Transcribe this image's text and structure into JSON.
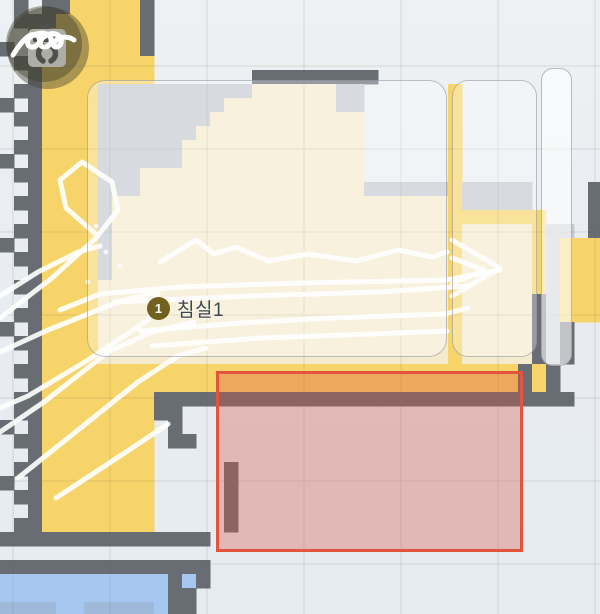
{
  "map": {
    "cell_size": 14,
    "room_label": {
      "badge": "1",
      "name": "침실1"
    },
    "palette": {
      "W": "#686d73",
      "Y": "#f6d469",
      "C": "#f4ebcd",
      "G": "#c5c9d0",
      "B": "#a6c8f0",
      "b": "#9fb9da"
    },
    "rows": [
      ".W.WWYYYYYW................................",
      ".WWWYYYYYYW................................",
      "..WYYYYYYYW................................",
      "W.WYYYYYYYW................................",
      ".WWYYYYYYYY................................",
      "..WYYYYYYYY.......WWWWWWWWW................",
      ".WWYYYYGGGGGGGGGGGCCCCCCGG......Y..........",
      "W.WYYYYGGGGGGGGGCCCCCCCCGG......Y..........",
      ".WWYYYYGGGGGGGGCCCCCCCCCCC......Y..........",
      "..WYYYYGGGGGGGCCCCCCCCCCCC......Y..........",
      ".WWYYYYGGGGGGCCCCCCCCCCCCC......Y..........",
      "W.WYYYYGGGGGGCCCCCCCCCCCCC......Y..........",
      ".WWYYYYGGGCCCCCCCCCCCCCCCC......Y..........",
      "..WYYYYGGGCCCCCCCCCCCCCCCCGGGGGGYGGGGG....W",
      ".WWYYYYGCCCCCCCCCCCCCCCCCCCCCCCCYGGGGG....W",
      "..WYYYYGCCCCCCCCCCCCCCCCCCCCCCCCYYYYYYY...W",
      ".WWYYYYGCCCCCCCCCCCCCCCCCCCCCCCCYCCCCCYGG.W",
      "W.WYYYYGCCCCCCCCCCCCCCCCCCCCCCCCYCCCCCYGYYY",
      ".WWYYYYGCCCCCCCCCCCCCCCCCCCCCCCCYCCCCCYGYYY",
      "..WYYYYGCCCCCCCCCCCCCCCCCCCCCCCCYCCCCCYGYYY",
      ".WWYYYYCCCCCCCCCCCCCCCCCCCCCCCCCYCCCCCYGYYY",
      "..WYYYYCCCCCCCCCCCCCCCCCCCCCCCCCYCCCCCWGYYY",
      ".WWYYYYCCCCCCCCCCCCCCCCCCCCCCCCCYCCCCCWGYYY",
      "W.WYYYYCCCCCCCCCCCCCCCCCCCCCCCCCYCCCCCWGW..",
      ".WWYYYYCCCCCCCCCCCCCCCCCCCCCCCCCYCCCCCWGW..",
      "..WYYYYCCCCCCCCCCCCCCCCCCCCCCCCCYCCCCCWGW..",
      ".WWYYYYYYYYYYYYYYYYYYYYYYYYYYYYYYYYYYWYW..",
      "..WYYYYYYYYYYYYYYYYYYYYYYYYYYYYYYYYYYWYW..",
      ".WWYYYYYYYYWWWWWWWWWWWWWWWWWWWWWWWWWWWWWW..",
      ".WWYYYYYYYYWW..............................",
      "W.WYYYYYYYY.W..............................",
      ".WWYYYYYYYY.WW.............................",
      "..WYYYYYYYY................................",
      ".WWYYYYYYYY.....W..........................",
      "W.WYYYYYYYY.....W..........................",
      ".WWYYYYYYYY.....W..........................",
      "..WYYYYYYYY.....W..........................",
      ".WWYYYYYYYY.....W..........................",
      "WWWWWWWWWWWWWWW............................",
      "...........................................",
      "WWWWWWWWWWWWWWW............................",
      "BBBBBBBBBBBBWBW............................",
      "BBBBBBBBBBBBWW.............................",
      "bbbbBBbbbbbBWW............................."
    ],
    "grid": {
      "v_start": 13,
      "v_gap": 97,
      "h_start": 66,
      "h_gap": 83,
      "color": "rgba(110,110,90,0.12)"
    },
    "path_color": "#ffffff",
    "paths": [
      [
        [
          0,
          318
        ],
        [
          52,
          278
        ],
        [
          96,
          238
        ],
        [
          118,
          210
        ],
        [
          112,
          182
        ],
        [
          82,
          162
        ],
        [
          60,
          180
        ],
        [
          66,
          208
        ],
        [
          98,
          236
        ]
      ],
      [
        [
          0,
          352
        ],
        [
          48,
          330
        ],
        [
          118,
          302
        ],
        [
          158,
          292
        ],
        [
          148,
          320
        ],
        [
          88,
          360
        ],
        [
          28,
          396
        ],
        [
          0,
          408
        ]
      ],
      [
        [
          0,
          432
        ],
        [
          44,
          402
        ],
        [
          108,
          352
        ],
        [
          152,
          332
        ],
        [
          194,
          322
        ]
      ],
      [
        [
          18,
          478
        ],
        [
          78,
          430
        ],
        [
          138,
          382
        ],
        [
          178,
          356
        ],
        [
          206,
          348
        ]
      ],
      [
        [
          56,
          498
        ],
        [
          126,
          452
        ],
        [
          168,
          424
        ]
      ],
      [
        [
          0,
          296
        ],
        [
          38,
          272
        ],
        [
          78,
          252
        ],
        [
          100,
          246
        ]
      ],
      [
        [
          60,
          310
        ],
        [
          100,
          294
        ],
        [
          180,
          287
        ],
        [
          300,
          283
        ],
        [
          446,
          280
        ],
        [
          500,
          270
        ]
      ],
      [
        [
          115,
          302
        ],
        [
          250,
          296
        ],
        [
          380,
          292
        ],
        [
          468,
          286
        ]
      ],
      [
        [
          160,
          262
        ],
        [
          196,
          240
        ],
        [
          214,
          254
        ],
        [
          236,
          247
        ],
        [
          268,
          261
        ],
        [
          308,
          254
        ],
        [
          356,
          261
        ],
        [
          398,
          250
        ],
        [
          432,
          257
        ],
        [
          447,
          252
        ]
      ],
      [
        [
          140,
          331
        ],
        [
          240,
          323
        ],
        [
          330,
          318
        ],
        [
          445,
          314
        ],
        [
          468,
          308
        ]
      ],
      [
        [
          152,
          346
        ],
        [
          262,
          338
        ],
        [
          398,
          333
        ],
        [
          447,
          331
        ]
      ],
      [
        [
          452,
          240
        ],
        [
          500,
          268
        ],
        [
          452,
          296
        ]
      ],
      [
        [
          452,
          258
        ],
        [
          484,
          270
        ],
        [
          452,
          284
        ]
      ]
    ],
    "dots": [
      [
        96,
        226
      ],
      [
        106,
        252
      ],
      [
        88,
        282
      ],
      [
        120,
        266
      ],
      [
        134,
        300
      ]
    ]
  },
  "overlays": {
    "panels": [
      {
        "x": 87,
        "y": 80,
        "w": 360,
        "h": 277,
        "r": 18,
        "bright": false
      },
      {
        "x": 452,
        "y": 80,
        "w": 85,
        "h": 277,
        "r": 16,
        "bright": false
      },
      {
        "x": 541,
        "y": 68,
        "w": 31,
        "h": 298,
        "r": 12,
        "bright": true
      }
    ]
  },
  "zone": {
    "x": 216,
    "y": 371,
    "w": 307,
    "h": 181,
    "border_color": "#e2553c",
    "fill": "rgba(217,84,71,0.34)"
  },
  "icons": {
    "dock": "charging-dock-icon",
    "robot": "robot-cleaning-path-icon",
    "circle_fill": "rgba(62,62,46,0.42)"
  }
}
